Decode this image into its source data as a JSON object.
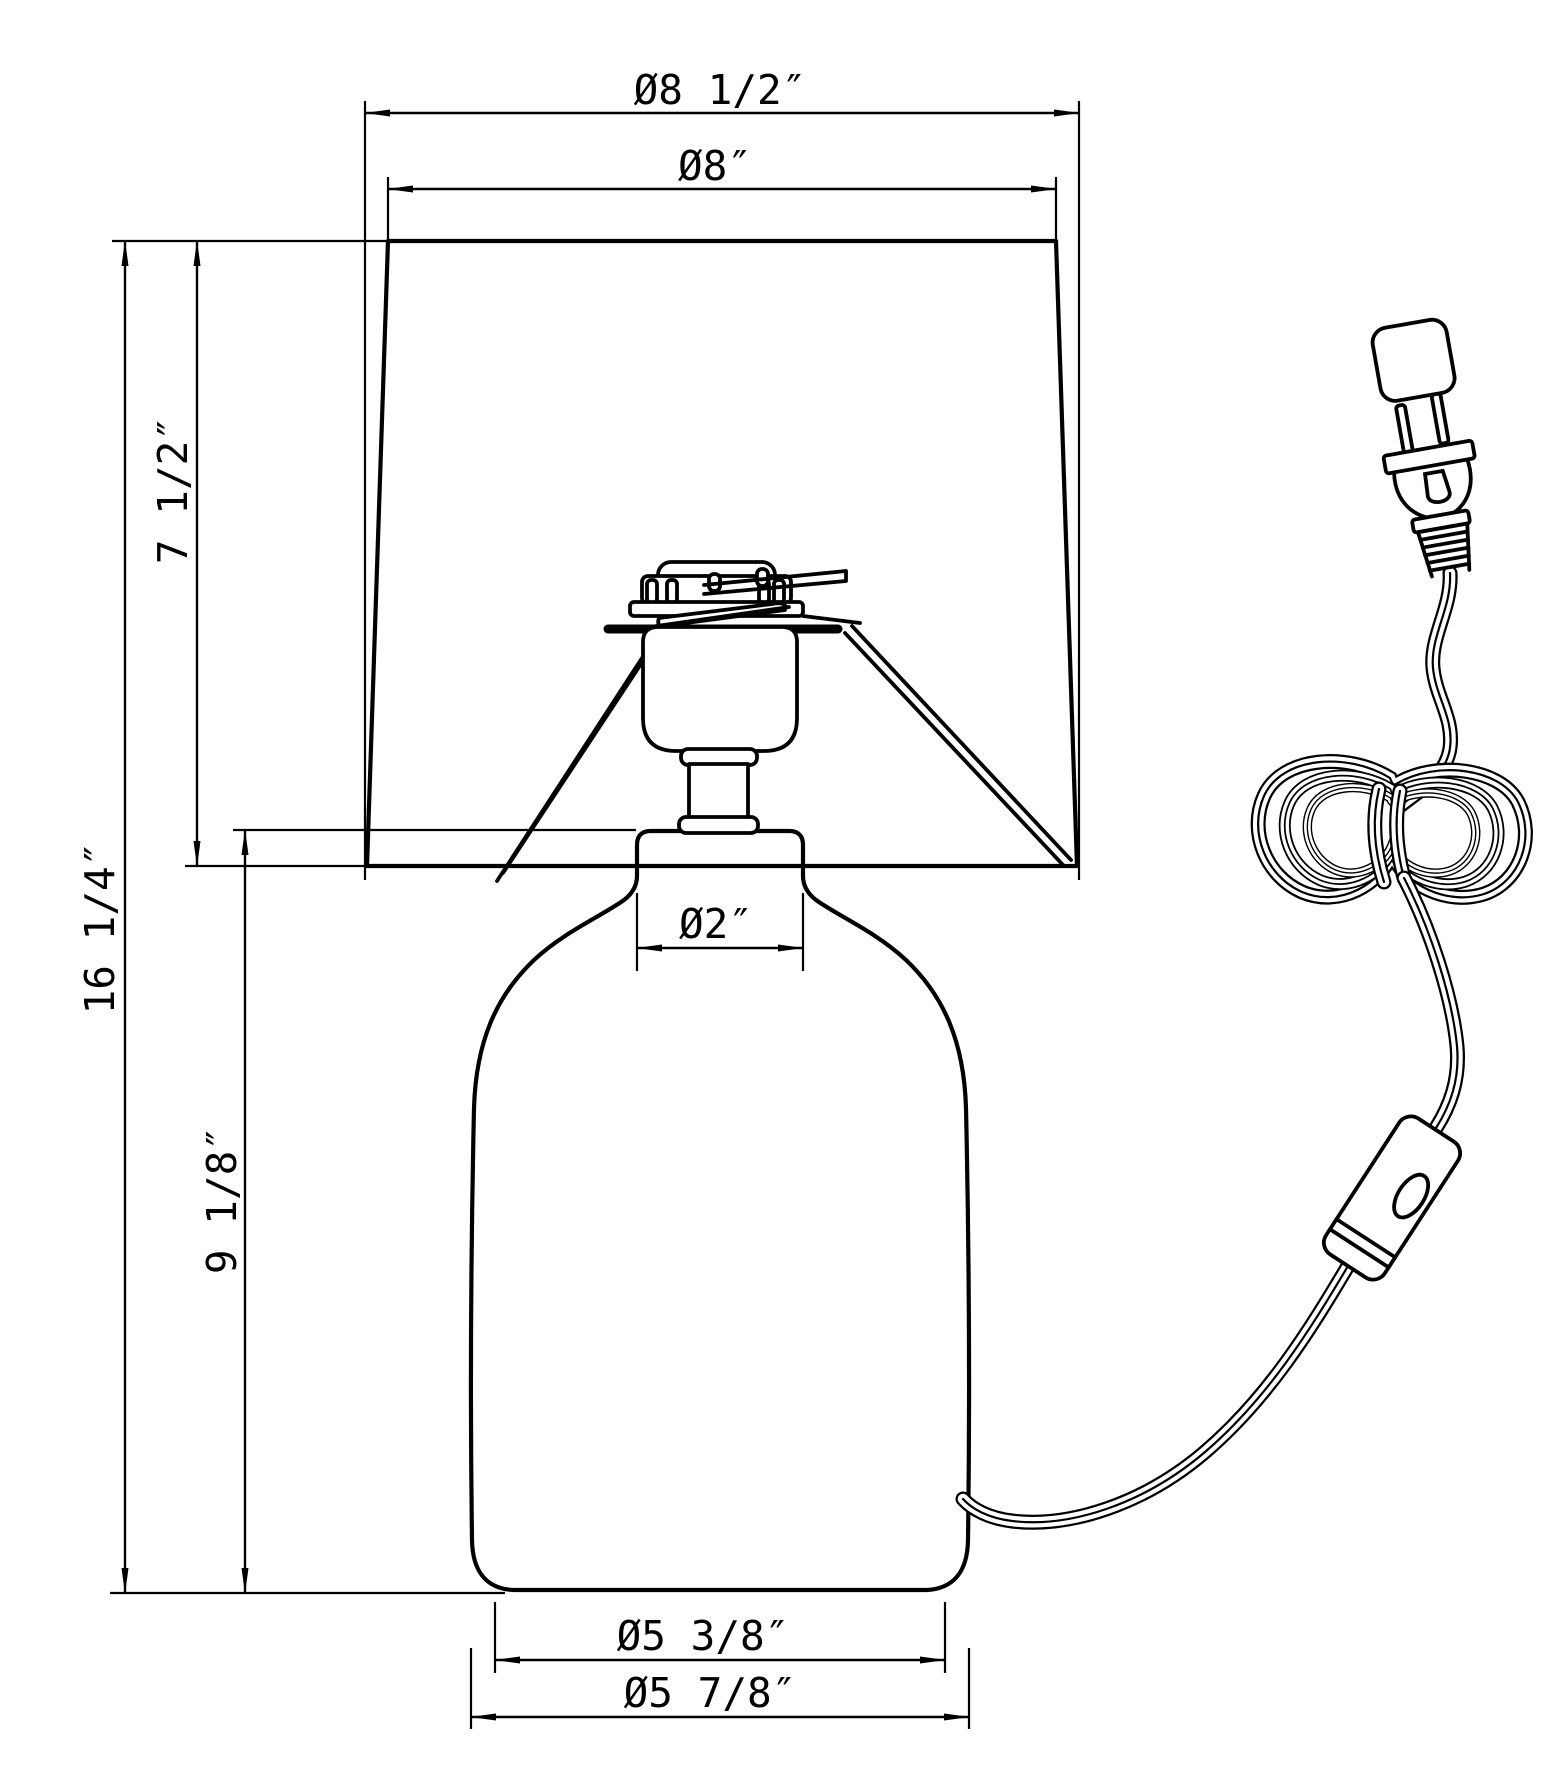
{
  "drawing": {
    "title": "Table lamp dimensional drawing",
    "units": "inches",
    "style": {
      "line_color": "#000000",
      "background_color": "#ffffff"
    },
    "labels": {
      "shade_bottom_diameter": "Ø8 1/2″",
      "shade_top_diameter": "Ø8″",
      "shade_height": "7 1/2″",
      "overall_height": "16 1/4″",
      "base_height": "9 1/8″",
      "neck_diameter": "Ø2″",
      "base_bottom_diameter": "Ø5 3/8″",
      "base_max_diameter": "Ø5 7/8″"
    }
  }
}
